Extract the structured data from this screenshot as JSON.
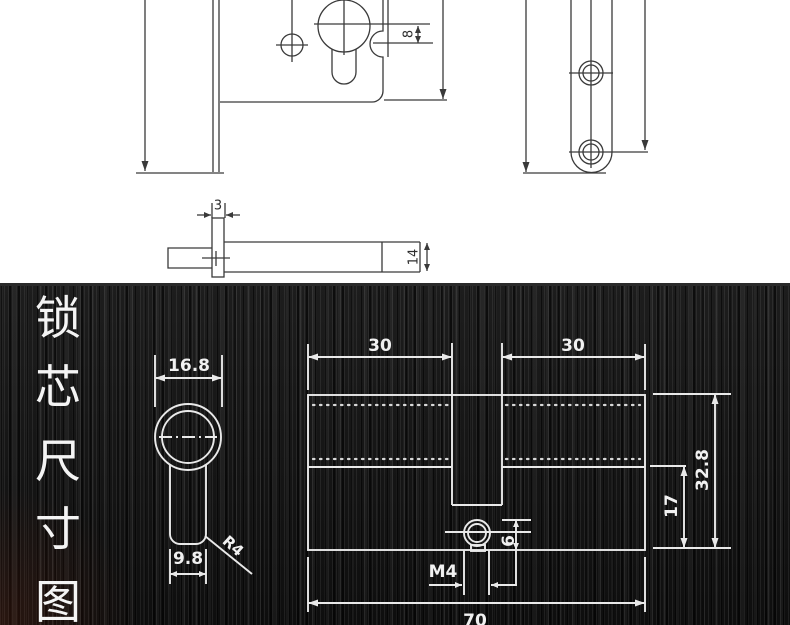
{
  "title": {
    "text": "锁芯尺寸图",
    "chars": [
      "锁",
      "芯",
      "尺",
      "寸",
      "图"
    ]
  },
  "plate_view": {
    "keyhole_notch_offset": "8"
  },
  "bolt_view": {
    "flange_thickness": "3",
    "bolt_height": "14"
  },
  "cylinder_front_view": {
    "head_diameter": "16.8",
    "body_width": "9.8",
    "corner_radius": "R4"
  },
  "cylinder_side_view": {
    "left_half_length": "30",
    "right_half_length": "30",
    "total_height": "32.8",
    "body_height": "17",
    "screw_edge_offset": "6",
    "screw_thread": "M4",
    "total_length": "70"
  },
  "colors": {
    "panel_background": "#131313",
    "panel_line": "#e9e9e9",
    "paper_line": "#3a3a3a"
  }
}
